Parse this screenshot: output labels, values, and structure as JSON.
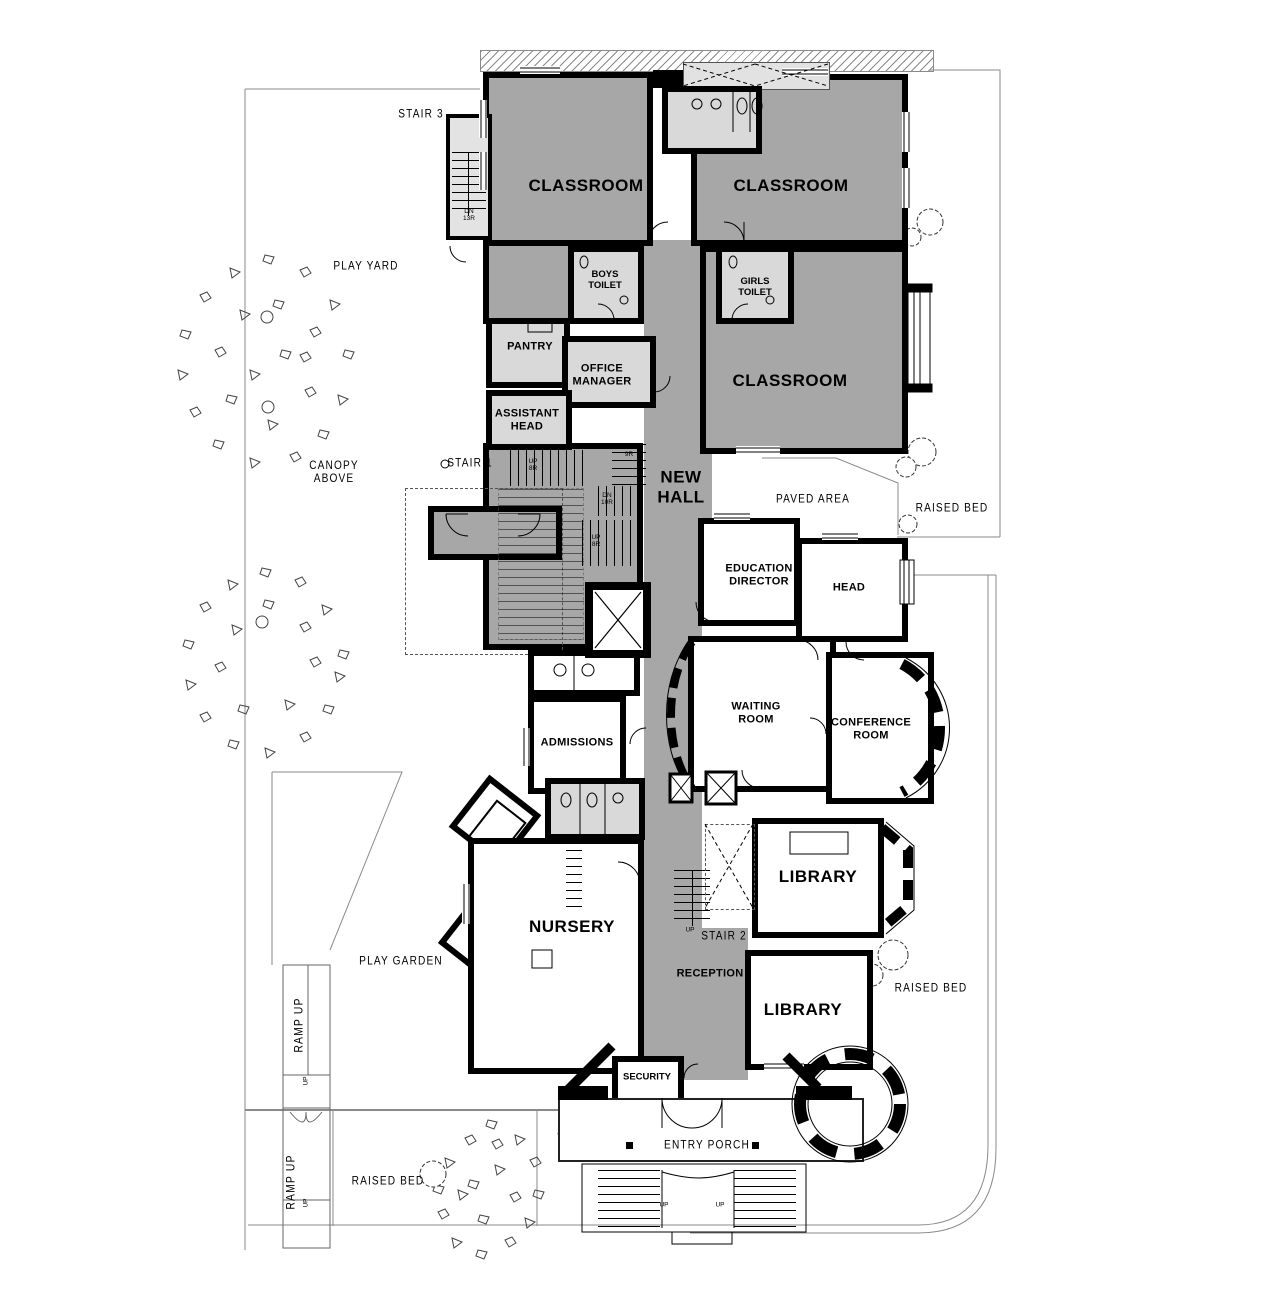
{
  "document": {
    "type": "architectural ground floor plan"
  },
  "colors": {
    "wall": "#000000",
    "hall_fill": "#a7a7a7",
    "service_fill": "#d9d9d9",
    "stair_fill": "#e3e3e3",
    "boundary": "#8a8a8a"
  },
  "rooms": {
    "classroom_tl": "CLASSROOM",
    "classroom_tr": "CLASSROOM",
    "classroom_mr": "CLASSROOM",
    "boys_toilet": "BOYS\nTOILET",
    "girls_toilet": "GIRLS\nTOILET",
    "pantry": "PANTRY",
    "office_manager": "OFFICE\nMANAGER",
    "assistant_head": "ASSISTANT\nHEAD",
    "new_hall": "NEW\nHALL",
    "education_director": "EDUCATION\nDIRECTOR",
    "head": "HEAD",
    "waiting_room": "WAITING\nROOM",
    "conference_room": "CONFERENCE\nROOM",
    "admissions": "ADMISSIONS",
    "library_upper": "LIBRARY",
    "library_lower": "LIBRARY",
    "nursery": "NURSERY",
    "reception": "RECEPTION",
    "security": "SECURITY"
  },
  "site": {
    "play_yard": "PLAY YARD",
    "play_garden": "PLAY GARDEN",
    "paved_area": "PAVED AREA",
    "canopy_above": "CANOPY\nABOVE",
    "entry_porch": "ENTRY PORCH",
    "raised_bed_right": "RAISED BED",
    "raised_bed_mid": "RAISED BED",
    "raised_bed_bottom": "RAISED BED",
    "ramp_up_top": "RAMP UP",
    "ramp_up_bottom": "RAMP UP"
  },
  "stairs": {
    "stair1": "STAIR 1",
    "stair2": "STAIR 2",
    "stair3": "STAIR 3",
    "dn_13r": "DN\n13R",
    "up_8r_upper": "UP\n8R",
    "up_9r": "UP\n9R",
    "dn_10r": "DN\n10R",
    "up_8r_lower": "UP\n8R",
    "up_stair2": "UP",
    "up_entry_left": "UP",
    "up_entry_right": "UP",
    "up_ramp_top": "UP",
    "up_ramp_bottom": "UP"
  }
}
